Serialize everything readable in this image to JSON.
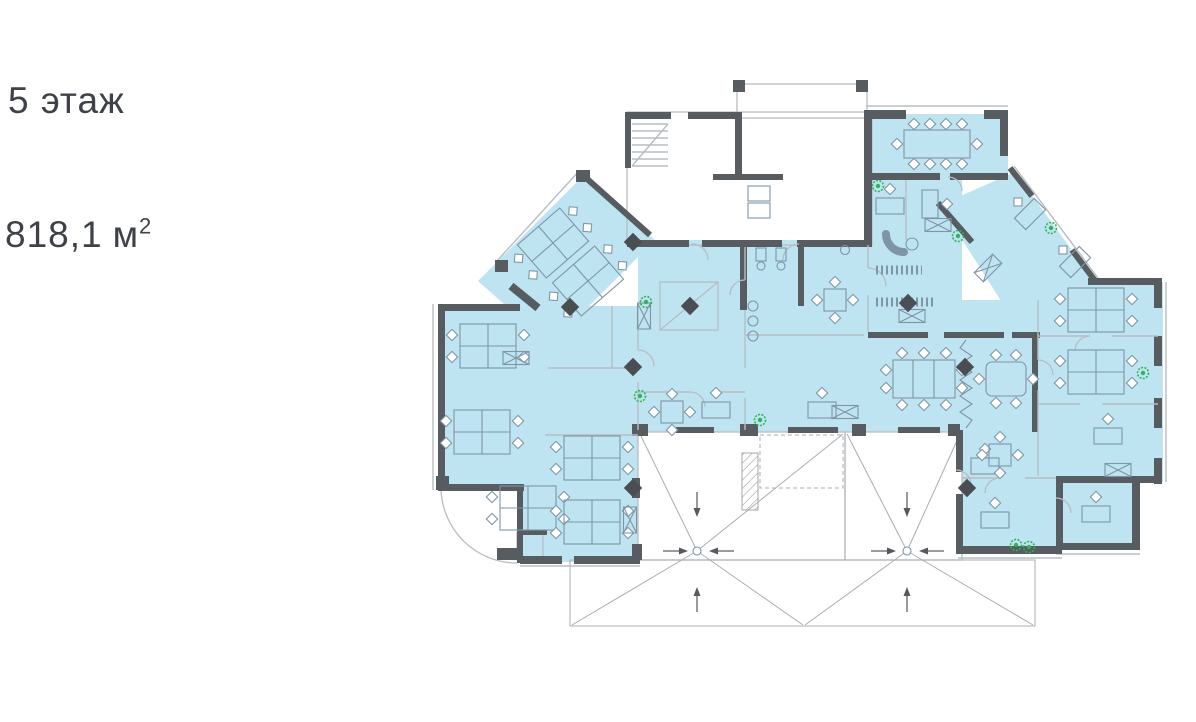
{
  "page": {
    "title_label": "5 этаж",
    "area_value": "818,1",
    "area_unit": "м",
    "area_sup": "2"
  },
  "floorplan": {
    "kind": "office-floor-plan",
    "floor_number": "5",
    "total_area_m2": "818,1",
    "highlight_meaning": "leasable-office-area"
  },
  "colors": {
    "background": "#ffffff",
    "plan_fill": "#BEE4F2",
    "walls": "#575C61",
    "furniture_line": "#7E95A6",
    "light_line": "#B6BDC3",
    "roof_line": "#A8ADB2",
    "plant_green": "#2FB457",
    "column_marker": "#4A4E52",
    "text": "#3E4147"
  }
}
